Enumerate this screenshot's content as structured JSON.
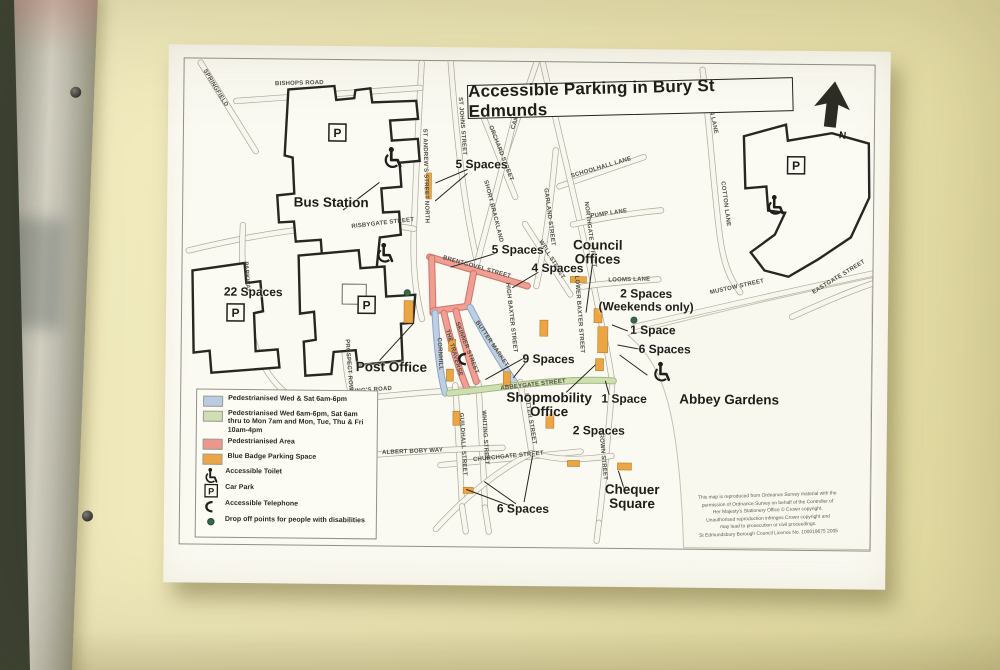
{
  "map": {
    "title": "Accessible Parking in Bury St Edmunds",
    "north": "N",
    "carpark_letter": "P",
    "pois": {
      "bus_station": "Bus Station",
      "post_office": "Post Office",
      "council_offices_1": "Council",
      "council_offices_2": "Offices",
      "shopmobility_1": "Shopmobility",
      "shopmobility_2": "Office",
      "abbey_gardens": "Abbey Gardens",
      "chequer_1": "Chequer",
      "chequer_2": "Square"
    },
    "spaces": {
      "bus": "5 Spaces",
      "brentgovel": "5 Spaces",
      "baxter": "4 Spaces",
      "risbygate": "22 Spaces",
      "weekends_1": "2 Spaces",
      "weekends_2": "(Weekends only)",
      "angel_one": "1 Space",
      "angel_six": "6 Spaces",
      "abbey_one": "1 Space",
      "market_nine": "9 Spaces",
      "hatter_two": "2 Spaces",
      "churchgate_six": "6 Spaces"
    },
    "streets": [
      "BISHOPS ROAD",
      "SPRINGFIELD",
      "ST ANDREW'S STREET NORTH",
      "ST JOHNS STREET",
      "CANNON ST",
      "ORCHARD STREET",
      "SHORT BRACKLAND",
      "WELL STREET",
      "GARLAND STREET",
      "SCHOOLHALL LANE",
      "COTTON LANE",
      "COTTON LANE",
      "EASTGATE STREET",
      "RISBYGATE STREET",
      "PARKWAY",
      "KING'S ROAD",
      "PROSPECT ROW",
      "ALBERT BOBY WAY",
      "PUMP LANE",
      "LOOMS LANE",
      "MUSTOW STREET",
      "NORTHGATE STREET",
      "BRENTGOVEL STREET",
      "HIGH BAXTER STREET",
      "LOWER BAXTER STREET",
      "BUTTER MARKET",
      "SKINNER STREET",
      "THE TRAVERSE",
      "CORNHILL",
      "ABBEYGATE STREET",
      "GUILDHALL STREET",
      "WHITING STREET",
      "HATTER STREET",
      "CHURCHGATE STREET",
      "CROWN STREET"
    ],
    "legend": {
      "items": [
        {
          "icon": "swatch-blue",
          "color": "#b8cbe4",
          "label": "Pedestrianised Wed & Sat 6am-6pm"
        },
        {
          "icon": "swatch-green",
          "color": "#cfdfb2",
          "label": "Pedestrianised Wed 6am-6pm, Sat 6am thru to Mon 7am and Mon, Tue, Thu & Fri 10am-4pm"
        },
        {
          "icon": "swatch-red",
          "color": "#ee938b",
          "label": "Pedestrianised Area"
        },
        {
          "icon": "swatch-orange",
          "color": "#eda23f",
          "label": "Blue Badge Parking Space"
        },
        {
          "icon": "wheelchair-icon",
          "label": "Accessible Toilet"
        },
        {
          "icon": "car-park-icon",
          "label": "Car Park"
        },
        {
          "icon": "telephone-icon",
          "label": "Accessible Telephone"
        },
        {
          "icon": "drop-off-dot-icon",
          "label": "Drop off points for people with disabilities"
        }
      ]
    },
    "copyright": [
      "This map is reproduced from Ordnance Survey material with the",
      "permission of Ordnance Survey on behalf of the Controller of",
      "Her Majesty's Stationery Office © Crown copyright.",
      "Unauthorised reproduction infringes Crown copyright and",
      "may lead to prosecution or civil proceedings.",
      "St Edmundsbury Borough Council    Licence No. 100019675  2005"
    ],
    "colors": {
      "pedestrian_blue": "#b8cbe4",
      "pedestrian_green": "#cfdfb2",
      "pedestrian_red": "#ee938b",
      "blue_badge_orange": "#eda23f",
      "drop_off_green": "#2f5f45"
    }
  }
}
